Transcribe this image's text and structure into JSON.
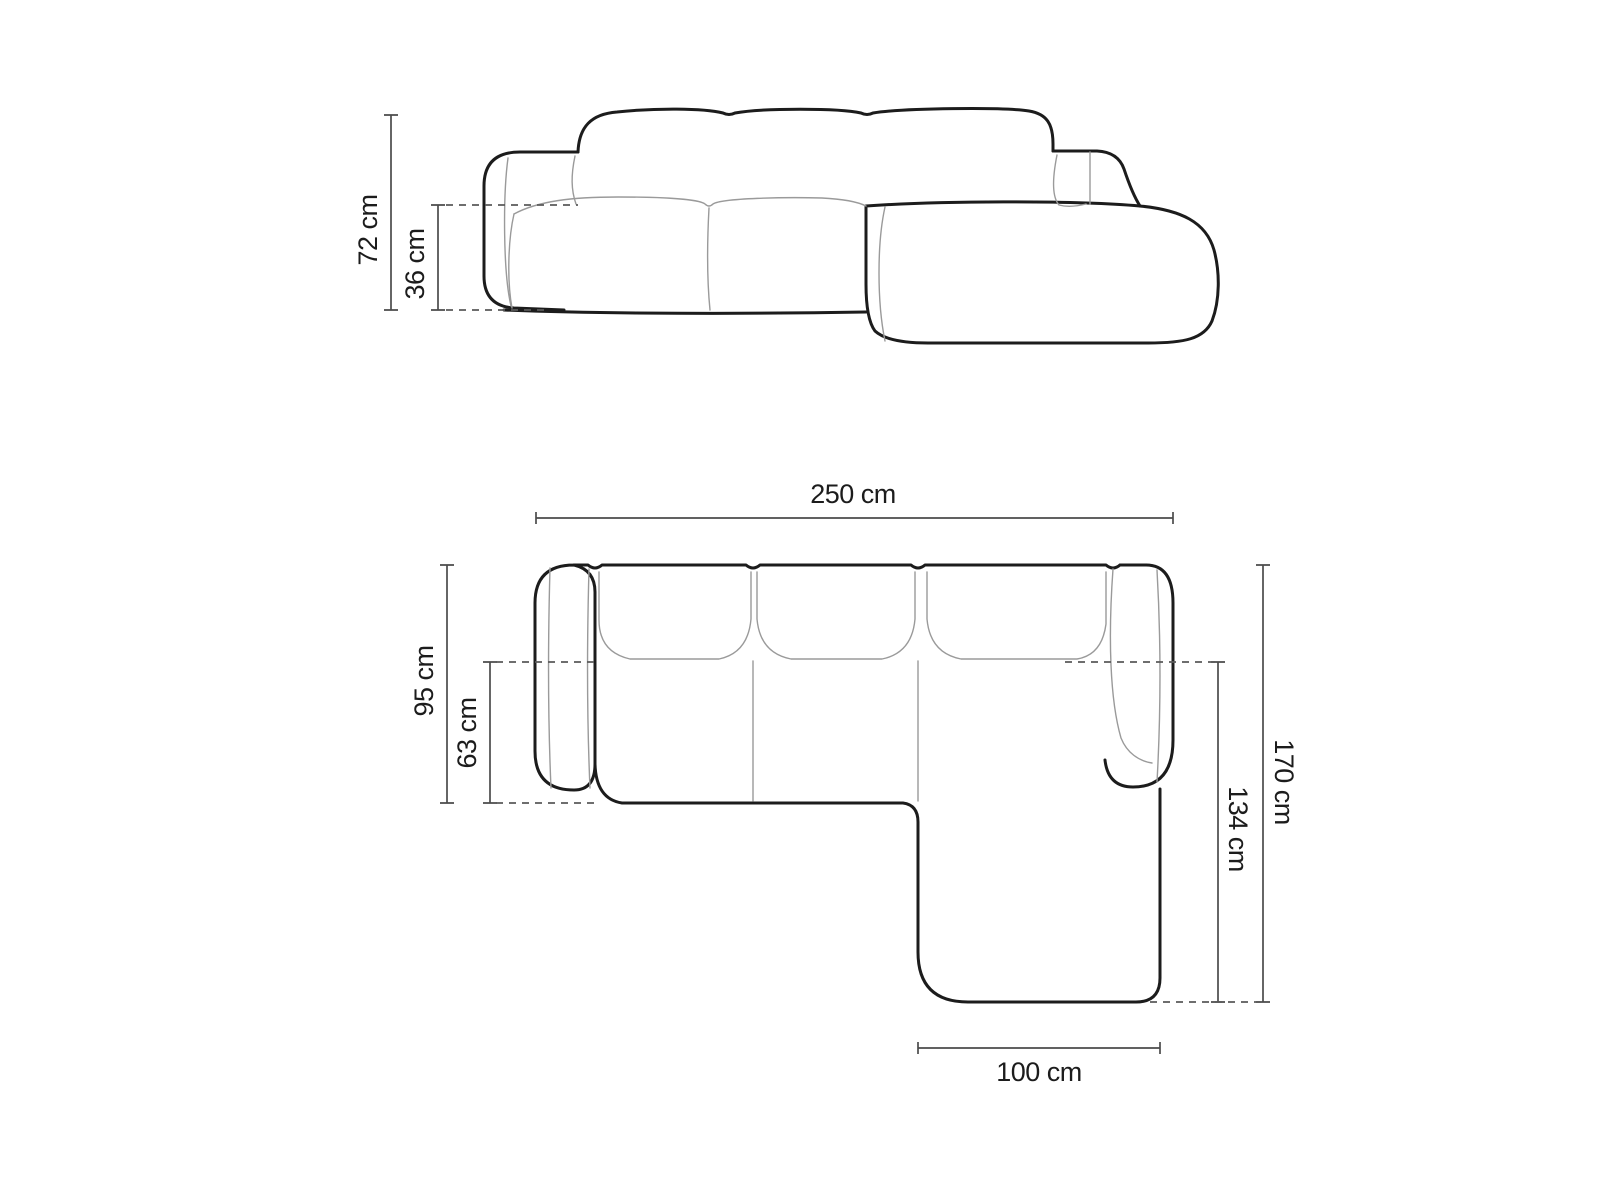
{
  "diagram": {
    "type": "furniture-dimension-drawing",
    "subject": "corner sofa with right chaise",
    "front_view": {
      "overall_height": {
        "label": "72 cm",
        "value_cm": 72
      },
      "seat_height": {
        "label": "36 cm",
        "value_cm": 36
      }
    },
    "top_view": {
      "overall_width": {
        "label": "250 cm",
        "value_cm": 250
      },
      "body_depth": {
        "label": "95 cm",
        "value_cm": 95
      },
      "seat_depth": {
        "label": "63 cm",
        "value_cm": 63
      },
      "overall_length": {
        "label": "170 cm",
        "value_cm": 170
      },
      "chaise_inner_length": {
        "label": "134 cm",
        "value_cm": 134
      },
      "chaise_width": {
        "label": "100 cm",
        "value_cm": 100
      }
    },
    "colors": {
      "outline_bold": "#1c1c1c",
      "outline_thin": "#9a9a9a",
      "dimension_line": "#4b4b4b",
      "text": "#1c1c1c",
      "background": "#ffffff"
    }
  }
}
